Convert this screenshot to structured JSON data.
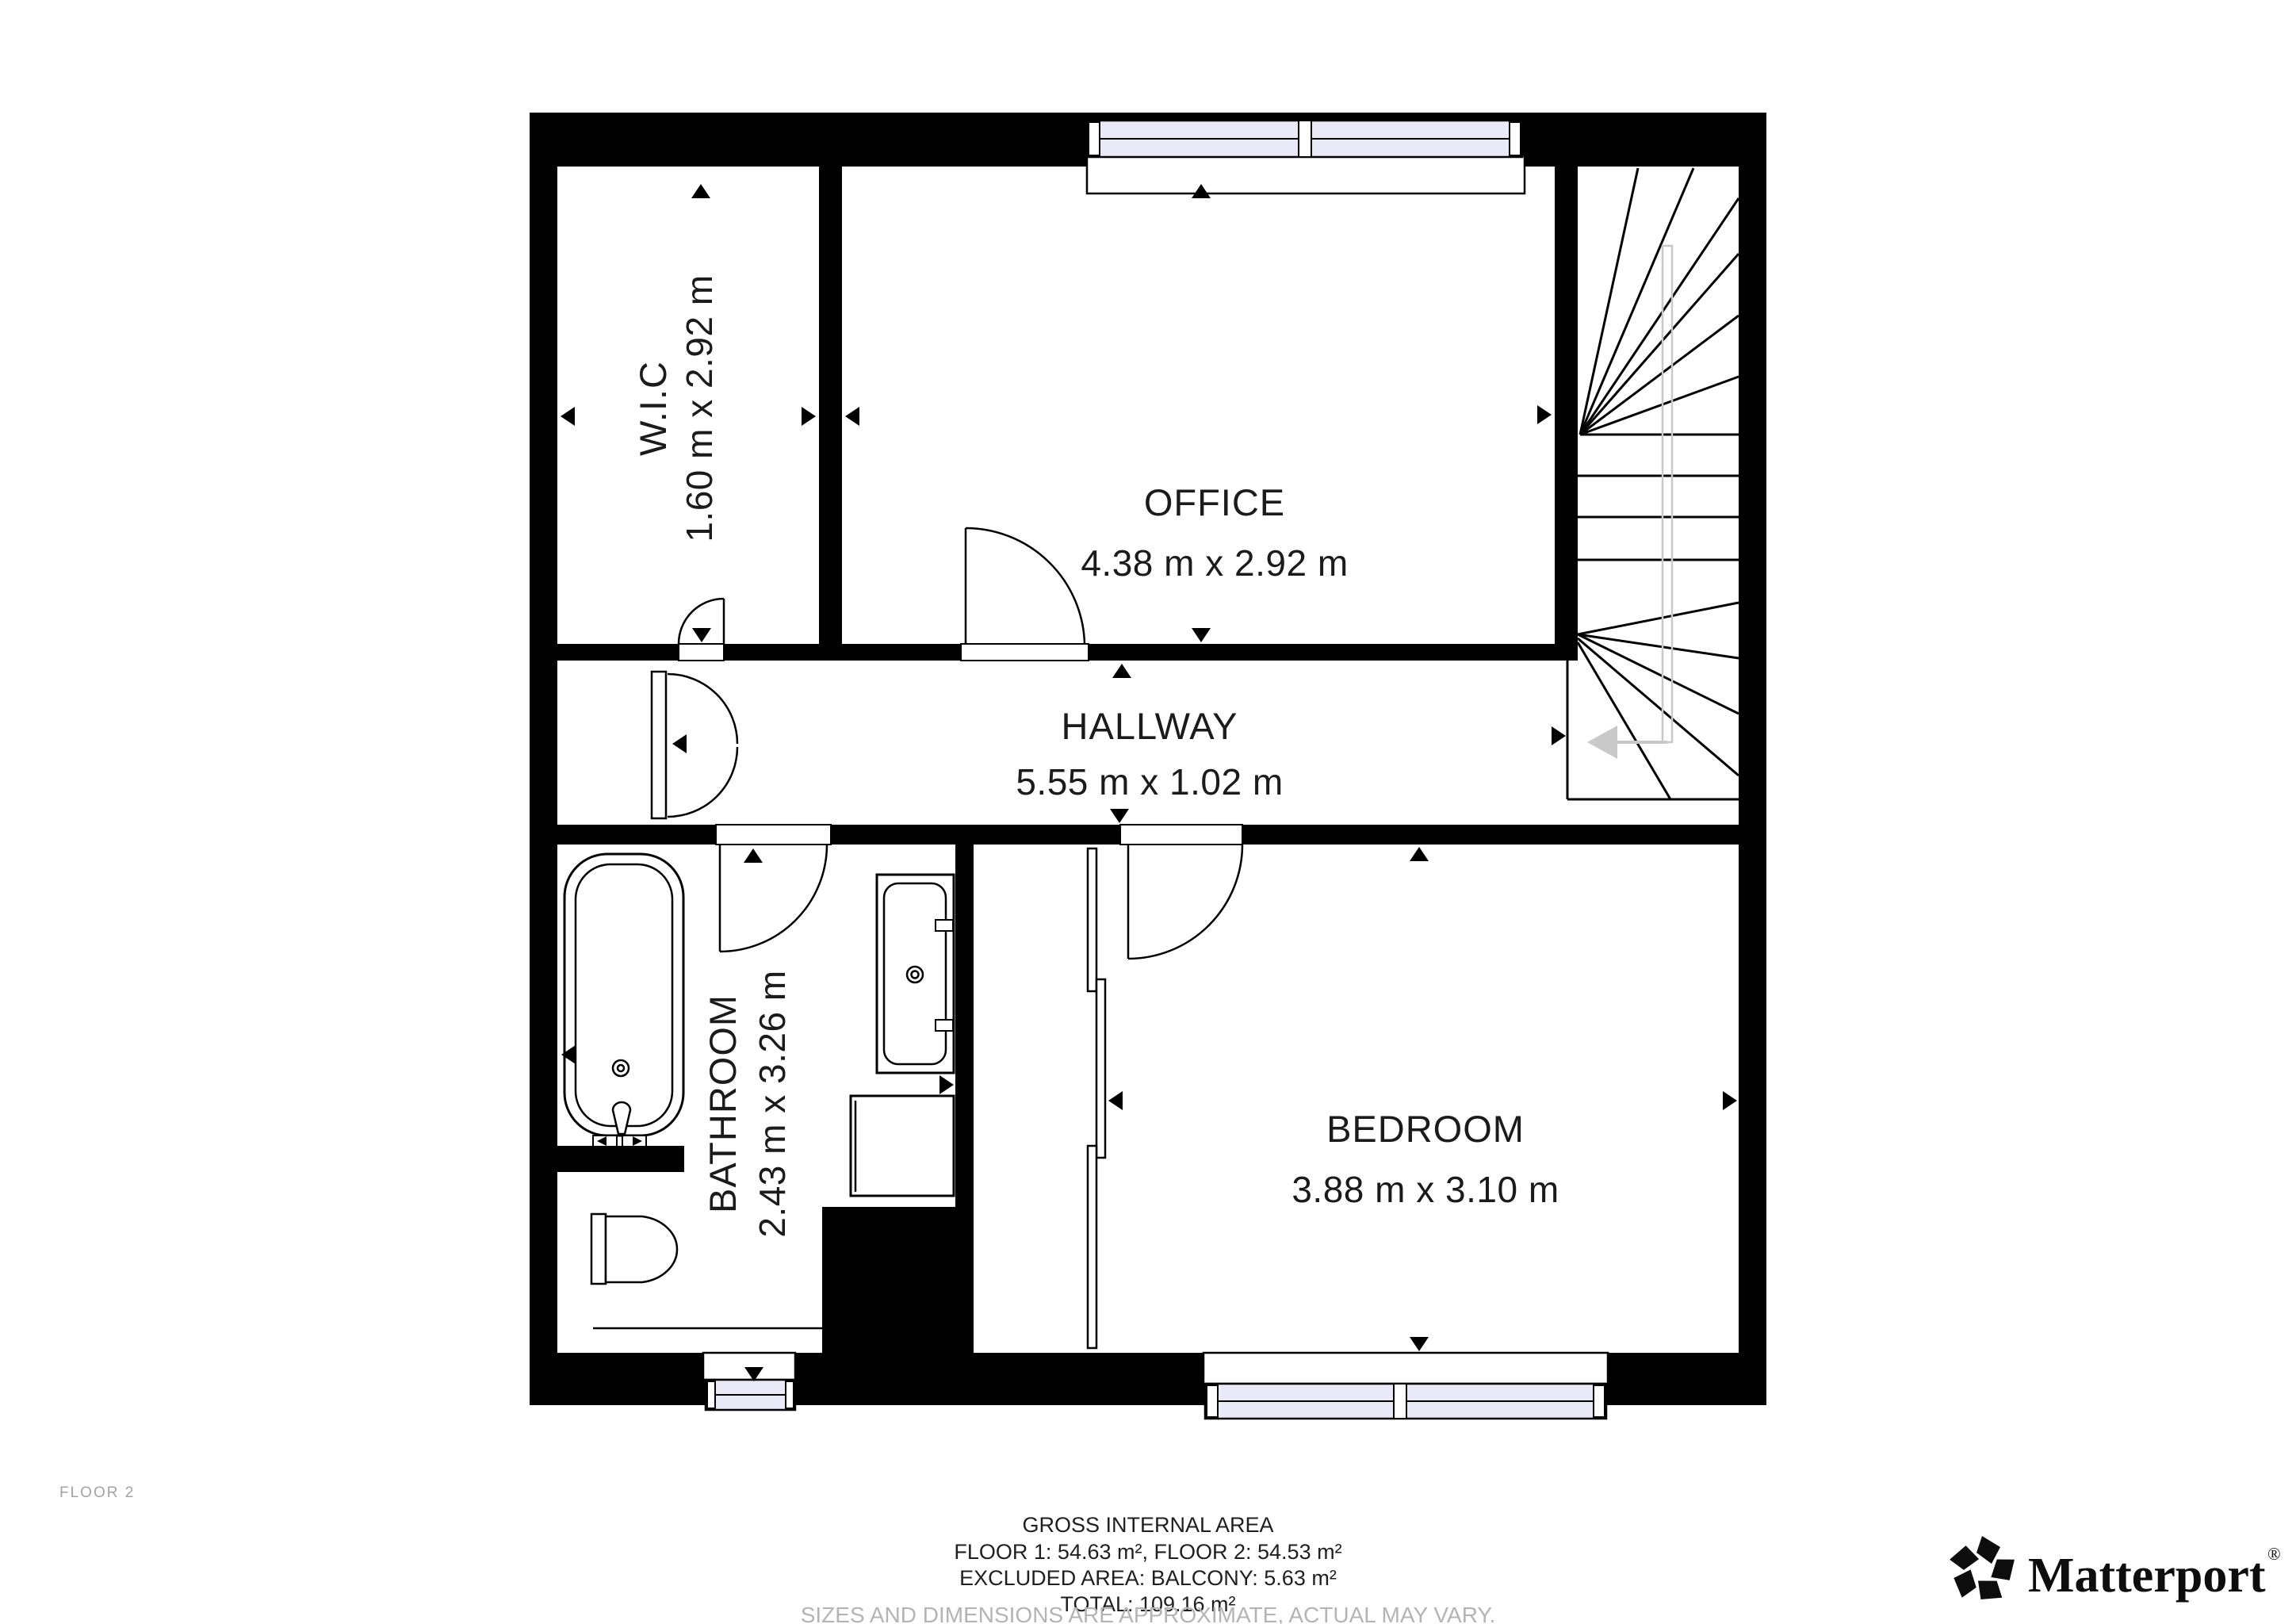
{
  "floor_plan": {
    "floor_label": "FLOOR 2",
    "rooms": [
      {
        "id": "wic",
        "name": "W.I.C",
        "dims": "1.60 m x 2.92 m"
      },
      {
        "id": "office",
        "name": "OFFICE",
        "dims": "4.38 m x 2.92 m"
      },
      {
        "id": "hallway",
        "name": "HALLWAY",
        "dims": "5.55 m x 1.02 m"
      },
      {
        "id": "bathroom",
        "name": "BATHROOM",
        "dims": "2.43 m x 3.26 m"
      },
      {
        "id": "bedroom",
        "name": "BEDROOM",
        "dims": "3.88 m x 3.10 m"
      }
    ],
    "footer": {
      "title": "GROSS INTERNAL AREA",
      "line_floors": "FLOOR 1: 54.63 m², FLOOR 2: 54.53 m²",
      "line_excluded": "EXCLUDED AREA: BALCONY: 5.63 m²",
      "line_total": "TOTAL: 109.16 m²",
      "disclaimer": "SIZES AND DIMENSIONS ARE APPROXIMATE, ACTUAL MAY VARY."
    },
    "brand": {
      "name": "Matterport",
      "registered": "®"
    },
    "colors": {
      "wall": "#000000",
      "window_fill": "#e9e9f7",
      "muted_text": "#a3a3a3",
      "stair_guide": "#c9c9c9",
      "background": "#ffffff"
    }
  }
}
